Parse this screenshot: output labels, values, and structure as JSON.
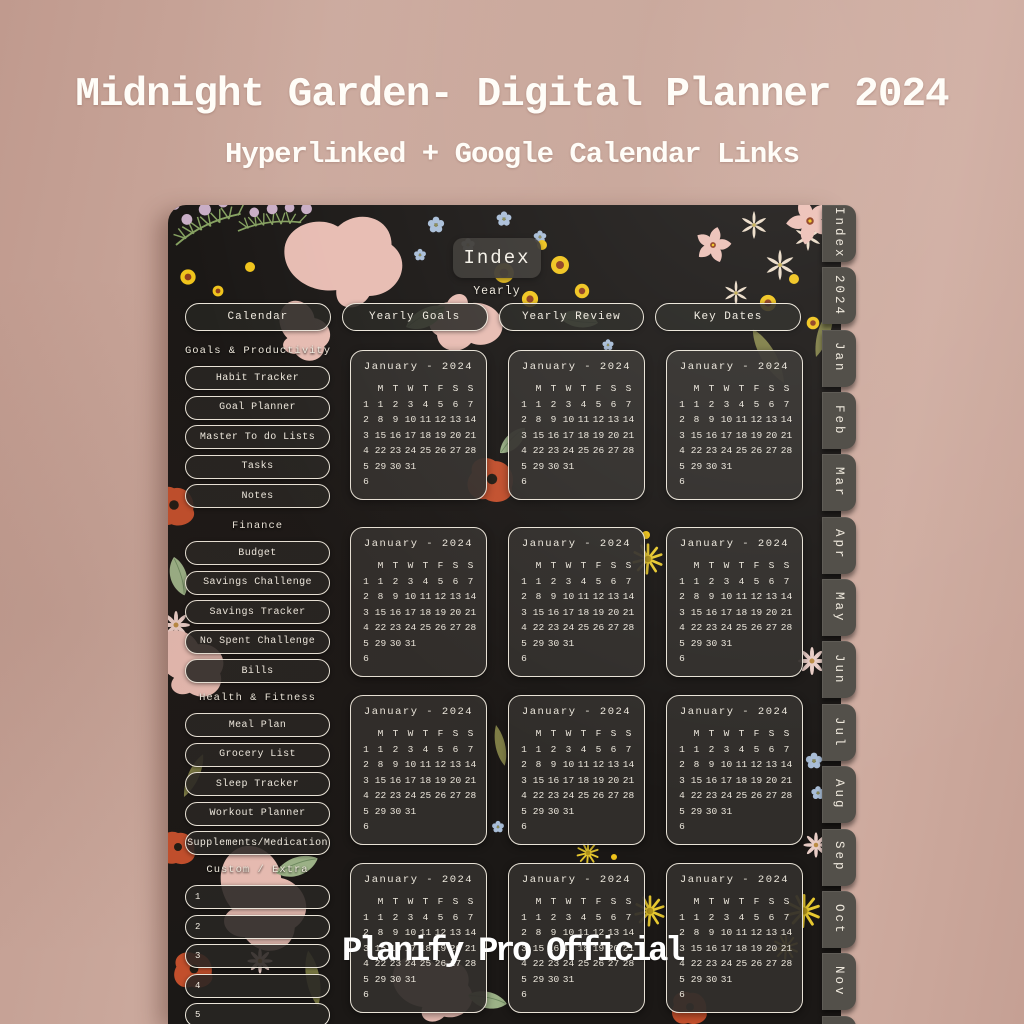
{
  "header": {
    "title": "Midnight Garden- Digital Planner 2024",
    "subtitle": "Hyperlinked + Google Calendar Links"
  },
  "watermark": "Planify Pro Official",
  "planner": {
    "page_title": "Index",
    "section_label": "Yearly",
    "top_buttons": [
      "Calendar",
      "Yearly Goals",
      "Yearly Review",
      "Key Dates"
    ],
    "sidebar": {
      "sections": [
        {
          "label": "Goals & Productivity",
          "numbered": false,
          "items": [
            "Habit Tracker",
            "Goal Planner",
            "Master To do Lists",
            "Tasks",
            "Notes"
          ]
        },
        {
          "label": "Finance",
          "numbered": false,
          "items": [
            "Budget",
            "Savings Challenge",
            "Savings Tracker",
            "No Spent Challenge",
            "Bills"
          ]
        },
        {
          "label": "Health & Fitness",
          "numbered": false,
          "items": [
            "Meal Plan",
            "Grocery List",
            "Sleep Tracker",
            "Workout Planner",
            "Supplements/Medication"
          ]
        },
        {
          "label": "Custom / Extra",
          "numbered": true,
          "items": [
            "1",
            "2",
            "3",
            "4",
            "5"
          ]
        }
      ]
    },
    "tabs": [
      "Index",
      "2024",
      "Jan",
      "Feb",
      "Mar",
      "Apr",
      "May",
      "Jun",
      "Jul",
      "Aug",
      "Sep",
      "Oct",
      "Nov",
      "Dec"
    ],
    "calendar_card": {
      "title": "January - 2024",
      "day_headers": [
        "M",
        "T",
        "W",
        "T",
        "F",
        "S",
        "S"
      ],
      "week_numbers": [
        "1",
        "2",
        "3",
        "4",
        "5",
        "6"
      ],
      "weeks": [
        [
          "1",
          "2",
          "3",
          "4",
          "5",
          "6",
          "7"
        ],
        [
          "8",
          "9",
          "10",
          "11",
          "12",
          "13",
          "14"
        ],
        [
          "15",
          "16",
          "17",
          "18",
          "19",
          "20",
          "21"
        ],
        [
          "22",
          "23",
          "24",
          "25",
          "26",
          "27",
          "28"
        ],
        [
          "29",
          "30",
          "31",
          "",
          "",
          "",
          ""
        ],
        [
          "",
          "",
          "",
          "",
          "",
          "",
          ""
        ]
      ],
      "instances": 12
    },
    "colors": {
      "background_rose": "#c9a89c",
      "planner_dark": "#1b1816",
      "tab_gray": "#53504a",
      "text_cream": "#f1ece1",
      "accent_yellow": "#f0c41c",
      "accent_red": "#c24f2c"
    }
  }
}
